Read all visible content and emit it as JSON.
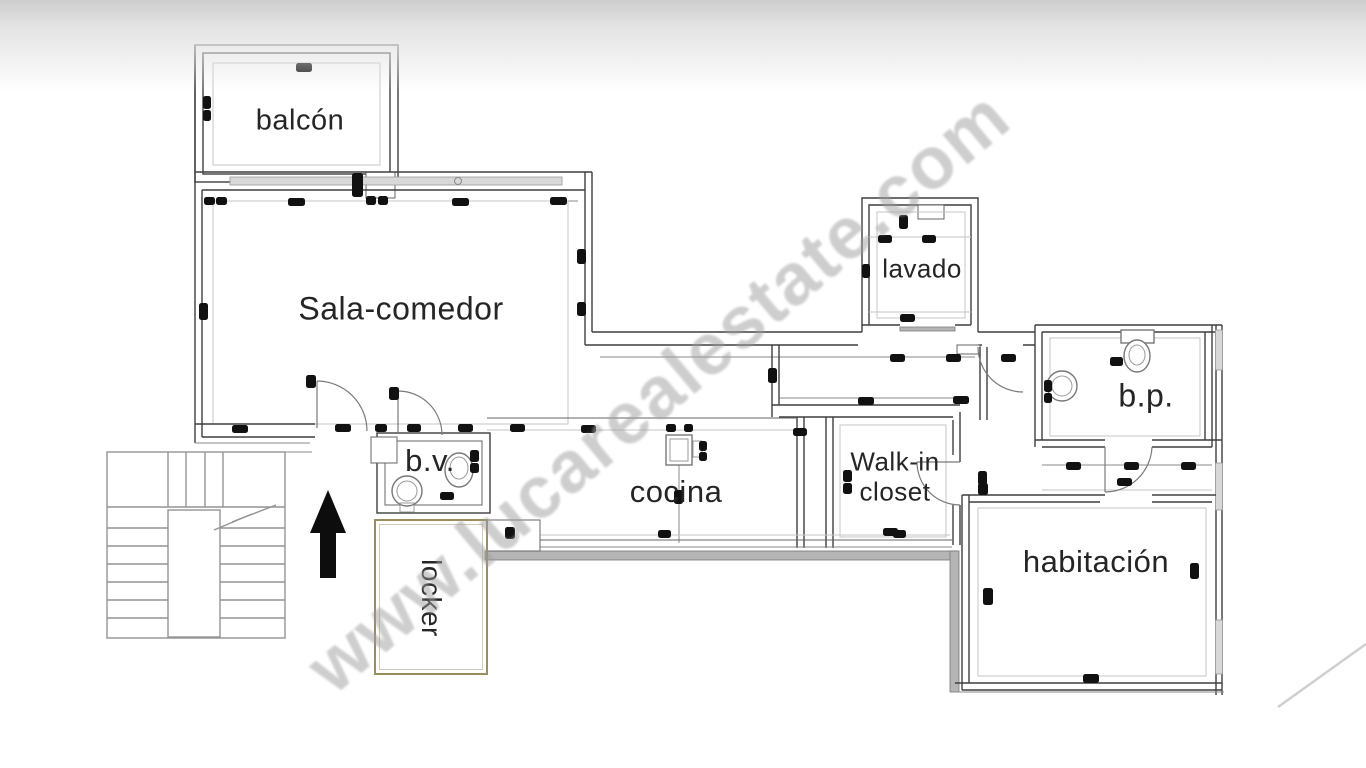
{
  "watermark": {
    "text": "www.lucarealestate.com"
  },
  "rooms": {
    "balcon": {
      "label": "balcón"
    },
    "sala": {
      "label": "Sala-comedor"
    },
    "lavado": {
      "label": "lavado"
    },
    "bp": {
      "label": "b.p."
    },
    "cocina": {
      "label": "cocina"
    },
    "closet": {
      "label_line1": "Walk-in",
      "label_line2": "closet"
    },
    "habitacion": {
      "label": "habitación"
    },
    "bv": {
      "label": "b.v."
    },
    "locker": {
      "label": "locker"
    }
  },
  "symbols": {
    "north_arrow": "up-arrow",
    "stairs": "u-shaped-staircase-with-break-line",
    "fixtures": [
      "toilet",
      "sink",
      "stove"
    ]
  },
  "colors": {
    "wall": "#3f3f3f",
    "light_line": "#c4c4c4",
    "mid_line": "#8a8a8a",
    "gray_wall": "#b5b5b5",
    "glass": "#d8d8d8",
    "stair": "#949494",
    "locker_border": "#9b8d5e",
    "arrow": "#0d0d0d",
    "label": "#252525",
    "watermark": "rgba(158,158,158,0.5)"
  },
  "dimension_marks": [
    [
      204,
      197,
      11,
      8
    ],
    [
      216,
      197,
      11,
      8
    ],
    [
      288,
      198,
      17,
      8
    ],
    [
      366,
      196,
      10,
      9
    ],
    [
      378,
      196,
      10,
      9
    ],
    [
      452,
      198,
      17,
      8
    ],
    [
      550,
      197,
      17,
      8
    ],
    [
      296,
      63,
      16,
      9
    ],
    [
      203,
      96,
      8,
      13
    ],
    [
      203,
      110,
      8,
      11
    ],
    [
      352,
      173,
      11,
      24
    ],
    [
      199,
      303,
      9,
      17
    ],
    [
      577,
      249,
      9,
      15
    ],
    [
      577,
      302,
      9,
      14
    ],
    [
      890,
      354,
      15,
      8
    ],
    [
      946,
      354,
      15,
      8
    ],
    [
      1001,
      354,
      15,
      8
    ],
    [
      768,
      368,
      9,
      15
    ],
    [
      899,
      215,
      9,
      14
    ],
    [
      878,
      235,
      14,
      8
    ],
    [
      922,
      235,
      14,
      8
    ],
    [
      862,
      264,
      8,
      14
    ],
    [
      900,
      314,
      15,
      8
    ],
    [
      510,
      424,
      15,
      8
    ],
    [
      581,
      425,
      15,
      8
    ],
    [
      666,
      424,
      10,
      8
    ],
    [
      684,
      424,
      9,
      8
    ],
    [
      699,
      441,
      8,
      10
    ],
    [
      699,
      452,
      8,
      9
    ],
    [
      674,
      490,
      9,
      14
    ],
    [
      658,
      530,
      13,
      8
    ],
    [
      893,
      530,
      13,
      8
    ],
    [
      793,
      428,
      14,
      8
    ],
    [
      858,
      397,
      16,
      8
    ],
    [
      953,
      396,
      16,
      8
    ],
    [
      843,
      470,
      9,
      12
    ],
    [
      843,
      483,
      9,
      11
    ],
    [
      883,
      528,
      15,
      8
    ],
    [
      978,
      471,
      9,
      14
    ],
    [
      1066,
      462,
      15,
      8
    ],
    [
      1124,
      462,
      15,
      8
    ],
    [
      1181,
      462,
      15,
      8
    ],
    [
      1117,
      478,
      15,
      8
    ],
    [
      1044,
      380,
      8,
      12
    ],
    [
      1044,
      393,
      8,
      10
    ],
    [
      1110,
      357,
      13,
      9
    ],
    [
      978,
      483,
      10,
      12
    ],
    [
      983,
      588,
      10,
      17
    ],
    [
      1190,
      563,
      9,
      16
    ],
    [
      1083,
      674,
      16,
      9
    ],
    [
      232,
      425,
      16,
      8
    ],
    [
      335,
      424,
      16,
      8
    ],
    [
      375,
      424,
      12,
      8
    ],
    [
      407,
      424,
      14,
      8
    ],
    [
      458,
      424,
      15,
      8
    ],
    [
      440,
      492,
      14,
      8
    ],
    [
      470,
      450,
      9,
      12
    ],
    [
      470,
      463,
      9,
      10
    ],
    [
      505,
      527,
      10,
      12
    ],
    [
      306,
      375,
      10,
      13
    ],
    [
      389,
      387,
      10,
      13
    ]
  ]
}
